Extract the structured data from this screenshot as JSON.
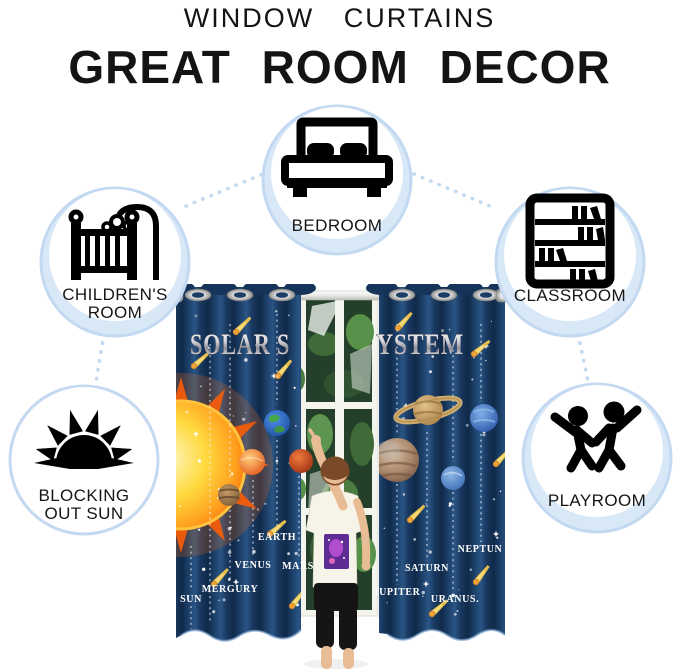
{
  "header": {
    "kicker": "WINDOW CURTAINS",
    "title": "GREAT ROOM DECOR"
  },
  "rooms": [
    {
      "name": "bedroom",
      "lines": [
        "BEDROOM"
      ],
      "icon": "bed-icon"
    },
    {
      "name": "childrens-room",
      "lines": [
        "CHILDREN'S",
        "ROOM"
      ],
      "icon": "crib-icon"
    },
    {
      "name": "classroom",
      "lines": [
        "CLASSROOM"
      ],
      "icon": "bookshelf-icon"
    },
    {
      "name": "blocking-out-sun",
      "lines": [
        "BLOCKING",
        "OUT SUN"
      ],
      "icon": "half-sun-icon"
    },
    {
      "name": "playroom",
      "lines": [
        "PLAYROOM"
      ],
      "icon": "children-playing-icon"
    }
  ],
  "curtain_photo": {
    "headline_left": "SOLAR S",
    "headline_right": "YSTEM",
    "headline_full": "SOLAR SYSTEM",
    "planet_labels": [
      "SUN",
      "MERGURY",
      "VENUS",
      "EARTH",
      "MARS",
      "JUPITER",
      "SATURN",
      "URANUS.",
      "NEPTUN"
    ]
  },
  "colors": {
    "badge_fill": "#d9e8f7",
    "badge_ring": "#c3d9f1",
    "connector_dots": "#c5d9ef",
    "curtain_navy": "#16355c",
    "comet_gold": "#e8bf4e",
    "headline_silver": "#cfcfd6",
    "label_white": "#ffffff",
    "text_black": "#141414"
  }
}
